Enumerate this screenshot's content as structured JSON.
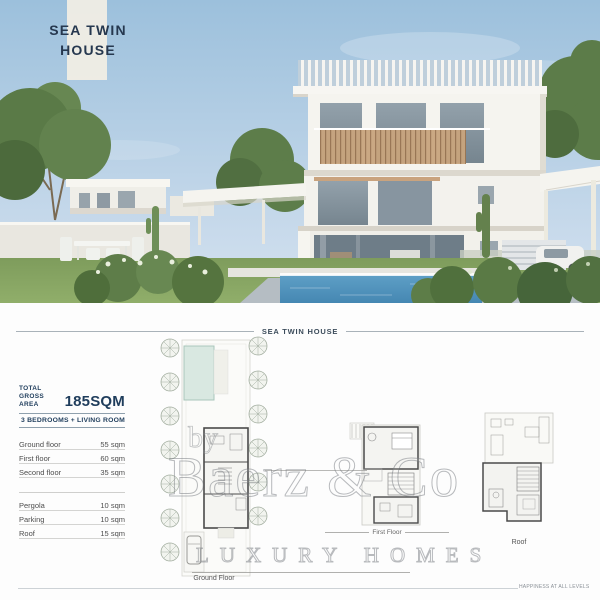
{
  "hero": {
    "title_line1": "SEA TWIN",
    "title_line2": "HOUSE"
  },
  "section": {
    "title": "SEA TWIN HOUSE"
  },
  "summary": {
    "total_label_line1": "TOTAL",
    "total_label_line2": "GROSS AREA",
    "total_value": "185SQM",
    "subtitle": "3 BEDROOMS + LIVING ROOM"
  },
  "area_table": {
    "main_rows": [
      {
        "label": "Ground floor",
        "value": "55 sqm"
      },
      {
        "label": "First floor",
        "value": "60 sqm"
      },
      {
        "label": "Second floor",
        "value": "35 sqm"
      }
    ],
    "extra_rows": [
      {
        "label": "Pergola",
        "value": "10 sqm"
      },
      {
        "label": "Parking",
        "value": "10 sqm"
      },
      {
        "label": "Roof",
        "value": "15 sqm"
      }
    ]
  },
  "plans": {
    "ground": {
      "label": "Ground Floor"
    },
    "first": {
      "label": "First Floor"
    },
    "roof": {
      "label": "Roof"
    }
  },
  "watermark": {
    "by": "by",
    "line1": "Baerz & Co",
    "line2": "LUXURY HOMES"
  },
  "footer": {
    "tagline": "HAPPINESS AT ALL LEVELS"
  },
  "colors": {
    "accent_navy": "#1f3d5c",
    "stripe_ivory": "#f3efe4",
    "sky_blue": "#9cc0dc",
    "pool_blue": "#4f94bd",
    "lawn_green": "#86a35f",
    "plan_pool_teal": "#d9e8e1",
    "watermark_gray": "#9aa0a5"
  }
}
